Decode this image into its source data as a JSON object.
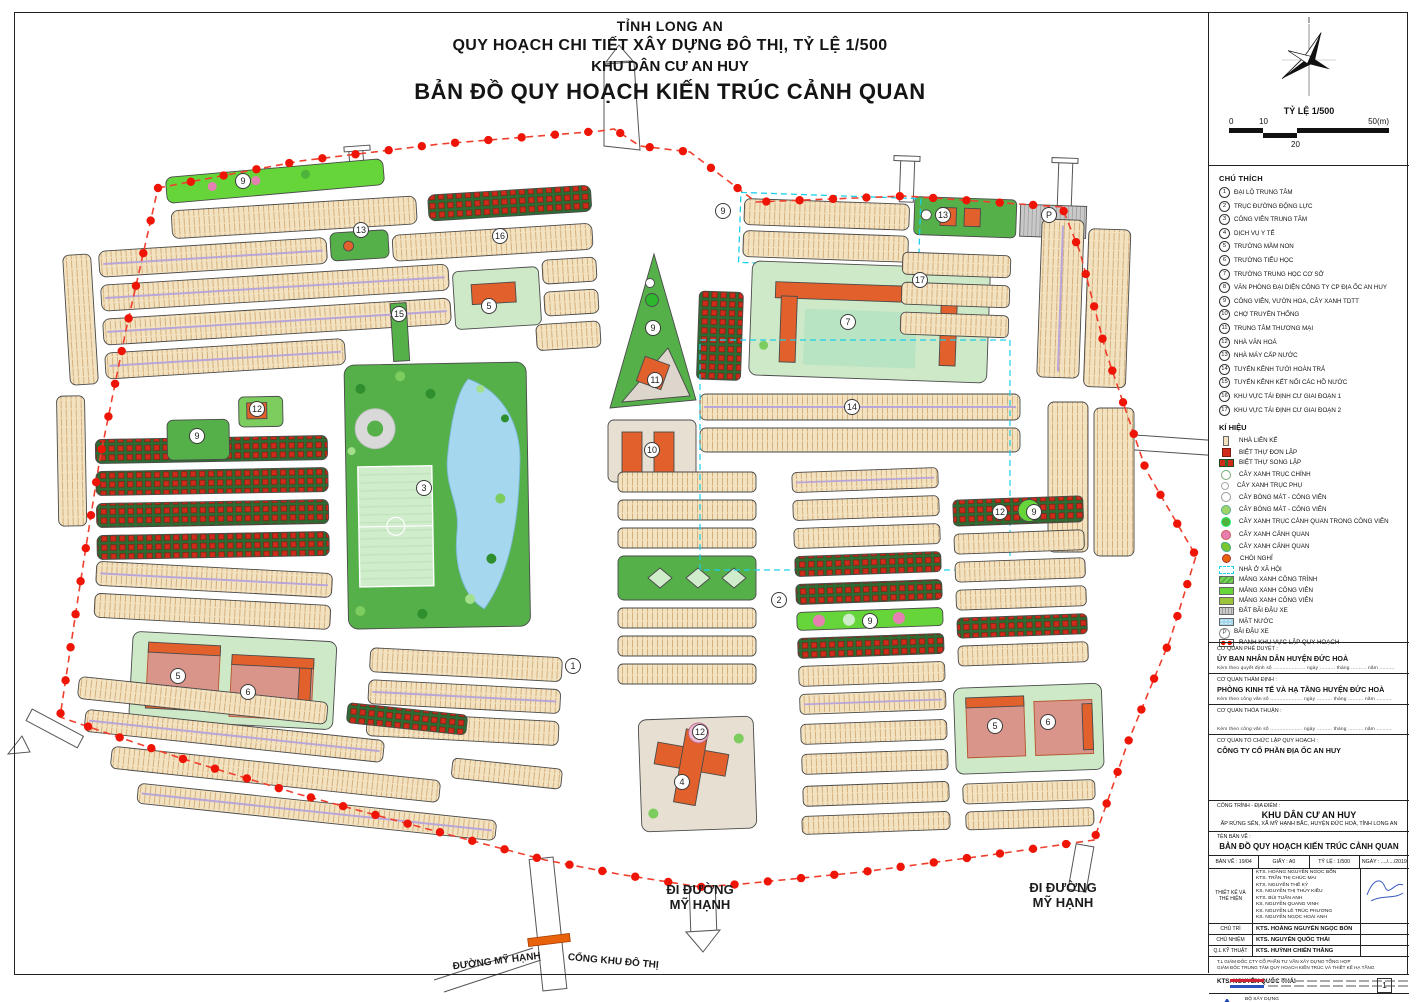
{
  "title": {
    "line1": "TỈNH LONG AN",
    "line2": "QUY HOẠCH CHI TIẾT XÂY DỰNG ĐÔ THỊ, TỶ LỆ 1/500",
    "line3": "KHU DÂN CƯ AN HUY",
    "line4": "BẢN ĐỒ QUY HOẠCH KIẾN TRÚC CẢNH QUAN"
  },
  "compass": {
    "north_label": "I"
  },
  "scalebar": {
    "title": "TỶ LỆ 1/500",
    "tick0": "0",
    "tick10": "10",
    "tick20": "20",
    "tick50": "50(m)"
  },
  "legend": {
    "heading": "CHÚ THÍCH",
    "items": [
      {
        "n": "1",
        "label": "ĐẠI LỘ TRUNG TÂM"
      },
      {
        "n": "2",
        "label": "TRỤC ĐƯỜNG ĐỘNG LỰC"
      },
      {
        "n": "3",
        "label": "CÔNG VIÊN TRUNG TÂM"
      },
      {
        "n": "4",
        "label": "DỊCH VỤ Y TẾ"
      },
      {
        "n": "5",
        "label": "TRƯỜNG MẦM NON"
      },
      {
        "n": "6",
        "label": "TRƯỜNG TIỂU HỌC"
      },
      {
        "n": "7",
        "label": "TRƯỜNG TRUNG HỌC CƠ SỞ"
      },
      {
        "n": "8",
        "label": "VĂN PHÒNG ĐẠI DIỆN CÔNG TY CP ĐỊA ỐC AN HUY"
      },
      {
        "n": "9",
        "label": "CÔNG VIÊN, VƯỜN HOA, CÂY XANH TDTT"
      },
      {
        "n": "10",
        "label": "CHỢ TRUYỀN THỐNG"
      },
      {
        "n": "11",
        "label": "TRUNG TÂM THƯƠNG MẠI"
      },
      {
        "n": "12",
        "label": "NHÀ VĂN HOÁ"
      },
      {
        "n": "13",
        "label": "NHÀ MÁY CẤP NƯỚC"
      },
      {
        "n": "14",
        "label": "TUYẾN KÊNH TƯỚI HOÀN TRẢ"
      },
      {
        "n": "15",
        "label": "TUYẾN KÊNH KẾT NỐI CÁC HỒ NƯỚC"
      },
      {
        "n": "16",
        "label": "KHU VỰC TÁI ĐỊNH CƯ GIAI ĐOẠN 1"
      },
      {
        "n": "17",
        "label": "KHU VỰC TÁI ĐỊNH CƯ GIAI ĐOẠN 2"
      }
    ]
  },
  "symbols": {
    "heading": "KÍ HIỆU",
    "items": [
      {
        "swatch": "house",
        "label": "NHÀ LIÊN KẾ"
      },
      {
        "swatch": "villa1",
        "label": "BIỆT THỰ ĐƠN LẬP"
      },
      {
        "swatch": "villa2",
        "label": "BIỆT THỰ SONG LẬP"
      },
      {
        "swatch": "tree tree-main",
        "label": "CÂY XANH TRỤC CHÍNH"
      },
      {
        "swatch": "tree tree-sub",
        "label": "CÂY XANH TRỤC PHỤ"
      },
      {
        "swatch": "tree tree-shade1",
        "label": "CÂY BÓNG MÁT - CÔNG VIÊN"
      },
      {
        "swatch": "tree tree-shade2",
        "label": "CÂY BÓNG MÁT - CÔNG VIÊN"
      },
      {
        "swatch": "tree tree-lspark",
        "label": "CÂY XANH TRỤC CẢNH QUAN TRONG CÔNG VIÊN"
      },
      {
        "swatch": "tree tree-pink",
        "label": "CÂY XANH CẢNH QUAN"
      },
      {
        "swatch": "tree tree-star",
        "label": "CÂY XANH CẢNH QUAN"
      },
      {
        "swatch": "gazebo",
        "label": "CHÒI NGHỈ"
      },
      {
        "swatch": "social",
        "label": "NHÀ Ở XÃ HỘI"
      },
      {
        "swatch": "green-hatch",
        "label": "MẢNG XANH CÔNG TRÌNH"
      },
      {
        "swatch": "green-bright",
        "label": "MẢNG XANH CÔNG VIÊN"
      },
      {
        "swatch": "green-olive",
        "label": "MẢNG XANH CÔNG VIÊN"
      },
      {
        "swatch": "parking-gray",
        "label": "ĐẤT BÃI ĐẬU XE"
      },
      {
        "swatch": "water",
        "label": "MẶT NƯỚC"
      },
      {
        "swatch": "parking-p",
        "label": "BÃI ĐẬU XE"
      },
      {
        "swatch": "boundary-red",
        "label": "RANH KHU VỰC LẬP QUY HOẠCH"
      }
    ]
  },
  "approvals": [
    {
      "caption": "CƠ QUAN PHÊ DUYỆT :",
      "name": "ỦY BAN NHÂN DÂN HUYỆN ĐỨC HOÀ",
      "note": "Kèm theo quyết định số ..................... ngày .......... tháng .......... năm .........."
    },
    {
      "caption": "CƠ QUAN THẨM ĐỊNH :",
      "name": "PHÒNG KINH TẾ VÀ HẠ TẦNG HUYỆN ĐỨC HOÀ",
      "note": "Kèm theo công văn số ..................... ngày .......... tháng .......... năm .........."
    },
    {
      "caption": "CƠ QUAN THỎA THUẬN :",
      "name": "",
      "note": "Kèm theo công văn số ..................... ngày .......... tháng .......... năm .........."
    },
    {
      "caption": "CƠ QUAN TỔ CHỨC LẬP QUY HOẠCH :",
      "name": "CÔNG TY CỔ PHẦN ĐỊA ỐC AN HUY",
      "note": ""
    }
  ],
  "titleblock": {
    "project_caption": "CÔNG TRÌNH - ĐỊA ĐIỂM :",
    "project_name": "KHU DÂN CƯ AN HUY",
    "project_address": "ẤP RỪNG SẾN, XÃ MỸ HẠNH BẮC, HUYỆN ĐỨC HOÀ, TỈNH LONG AN",
    "drawing_caption": "TÊN BẢN VẼ :",
    "drawing_name": "BẢN ĐỒ QUY HOẠCH KIẾN TRÚC CẢNH QUAN",
    "cells": [
      "BẢN VẼ : 19/04",
      "GIẤY : A0",
      "TỶ LỆ : 1/500",
      "NGÀY : ..../..../2019"
    ],
    "designers_label": "THIẾT KẾ VÀ THỂ HIỆN",
    "designers": [
      "KTS. HOÀNG NGUYỄN NGỌC BỔN",
      "KTS. TRẦN THỊ CHÚC MAI",
      "KTS. NGUYỄN THẾ KỶ",
      "KS. NGUYỄN THỊ THỦY KIỀU",
      "KTS. BÙI TUẤN ANH",
      "KS. NGUYỄN QUANG VINH",
      "KS. NGUYỄN LÊ TRÚC PHƯƠNG",
      "KS. NGUYỄN NGỌC HOÀI ANH"
    ],
    "roles": [
      {
        "label": "CHỦ TRÌ",
        "name": "KTS. HOÀNG NGUYỄN NGỌC BỔN"
      },
      {
        "label": "CHỦ NHIỆM",
        "name": "KTS. NGUYỄN QUỐC THÁI"
      },
      {
        "label": "Q.L KỸ THUẬT",
        "name": "KTS. HUỲNH CHIẾN THẮNG"
      }
    ],
    "note1": "T.L GIÁM ĐỐC CTY CỔ PHẦN TƯ VẤN XÂY DỰNG TỔNG HỢP",
    "note2": "GIÁM ĐỐC TRUNG TÂM QUY HOẠCH KIẾN TRÚC VÀ THIẾT KẾ HẠ TẦNG",
    "signer": "KTS. NGUYỄN QUỐC THÁI",
    "agency": "BỘ XÂY DỰNG",
    "company": "CTY CỔ PHẦN TƯ VẤN XÂY DỰNG TỔNG HỢP",
    "logo_text": "NAGECCO",
    "page_number": "1"
  },
  "map": {
    "road_labels": [
      {
        "lines": [
          "ĐI ĐƯỜNG",
          "MỸ HẠNH"
        ],
        "x": 700,
        "y": 894,
        "size": 13,
        "rotate": 0
      },
      {
        "lines": [
          "ĐI ĐƯỜNG",
          "MỸ HẠNH"
        ],
        "x": 1063,
        "y": 892,
        "size": 13,
        "rotate": 0
      },
      {
        "lines": [
          "ĐƯỜNG MỸ HẠNH"
        ],
        "x": 497,
        "y": 964,
        "size": 10,
        "rotate": -7
      },
      {
        "lines": [
          "CỔNG KHU ĐÔ THỊ"
        ],
        "x": 613,
        "y": 964,
        "size": 10,
        "rotate": 5
      }
    ],
    "markers": [
      {
        "label": "9",
        "x": 243,
        "y": 181
      },
      {
        "label": "13",
        "x": 361,
        "y": 230
      },
      {
        "label": "16",
        "x": 500,
        "y": 236
      },
      {
        "label": "15",
        "x": 399,
        "y": 314
      },
      {
        "label": "5",
        "x": 489,
        "y": 306
      },
      {
        "label": "12",
        "x": 257,
        "y": 409
      },
      {
        "label": "9",
        "x": 197,
        "y": 436
      },
      {
        "label": "3",
        "x": 424,
        "y": 488
      },
      {
        "label": "1",
        "x": 573,
        "y": 666
      },
      {
        "label": "5",
        "x": 178,
        "y": 676
      },
      {
        "label": "6",
        "x": 248,
        "y": 692
      },
      {
        "label": "9",
        "x": 653,
        "y": 328
      },
      {
        "label": "11",
        "x": 655,
        "y": 380
      },
      {
        "label": "10",
        "x": 652,
        "y": 450
      },
      {
        "label": "12",
        "x": 700,
        "y": 732
      },
      {
        "label": "4",
        "x": 682,
        "y": 782
      },
      {
        "label": "9",
        "x": 723,
        "y": 211
      },
      {
        "label": "13",
        "x": 943,
        "y": 215
      },
      {
        "label": "P",
        "x": 1049,
        "y": 215
      },
      {
        "label": "17",
        "x": 920,
        "y": 280
      },
      {
        "label": "7",
        "x": 848,
        "y": 322
      },
      {
        "label": "14",
        "x": 852,
        "y": 407
      },
      {
        "label": "2",
        "x": 779,
        "y": 600
      },
      {
        "label": "9",
        "x": 870,
        "y": 621
      },
      {
        "label": "12",
        "x": 1000,
        "y": 512
      },
      {
        "label": "9",
        "x": 1034,
        "y": 512
      },
      {
        "label": "5",
        "x": 995,
        "y": 726
      },
      {
        "label": "6",
        "x": 1048,
        "y": 722
      }
    ],
    "colors": {
      "boundary": "#ee1507",
      "rowhouse": "#f3e2c0",
      "villa": "#cf2a1a",
      "park_green": "#55b04a",
      "bright_green": "#66d53a",
      "water": "#a5d7ee",
      "building_orange": "#e2602c",
      "social_housing_dash": "#1ad0ea",
      "street_tree": "#b9a6d8"
    }
  }
}
